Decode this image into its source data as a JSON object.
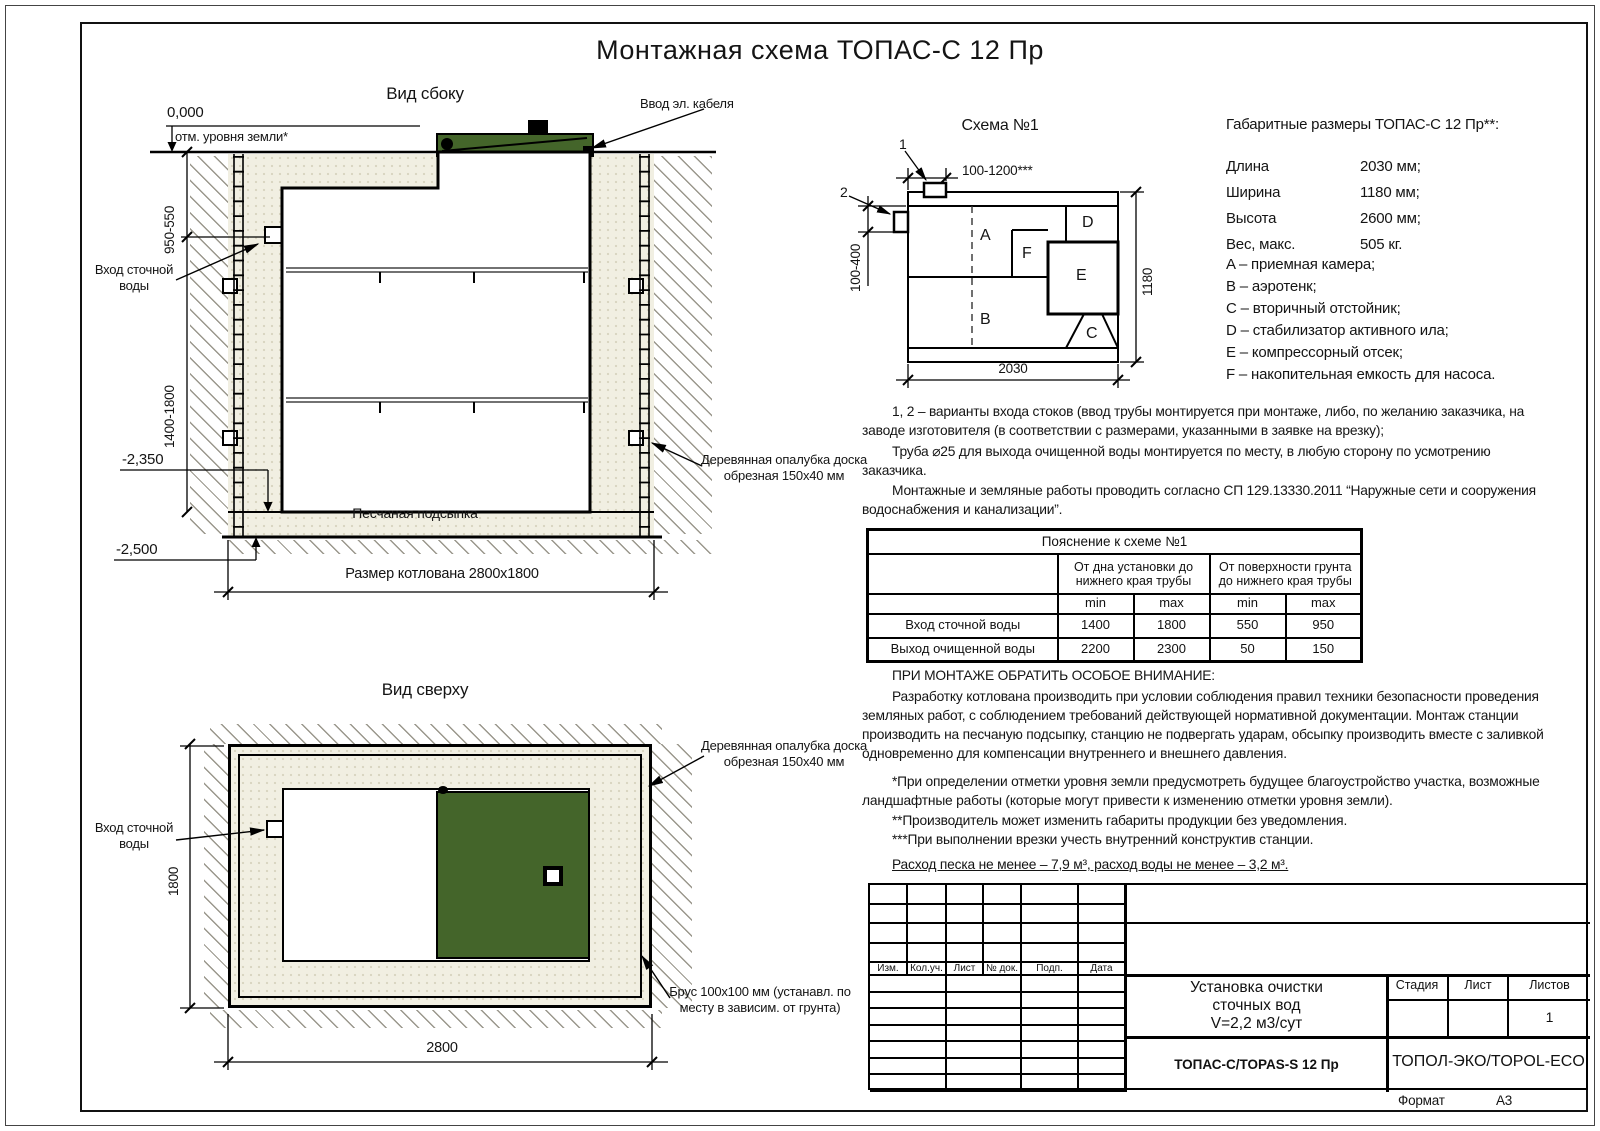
{
  "page": {
    "title": "Монтажная схема ТОПАС-С 12 Пр",
    "format_label": "Формат",
    "format_value": "А3"
  },
  "side_view": {
    "label": "Вид сбоку",
    "elev_zero": "0,000",
    "elev_zero_note": "отм. уровня земли*",
    "dim_upper": "950-550",
    "dim_lower": "1400-1800",
    "inlet_label": "Вход сточной воды",
    "elev_sand": "-2,350",
    "elev_bottom": "-2,500",
    "cable_label": "Ввод эл. кабеля",
    "formwork_label": "Деревянная опалубка доска обрезная 150x40 мм",
    "sand_label": "Песчаная подсыпка",
    "pit_dim": "Размер котлована 2800x1800"
  },
  "top_view": {
    "label": "Вид сверху",
    "inlet_label": "Вход сточной воды",
    "dim_width": "1800",
    "dim_length": "2800",
    "formwork_label": "Деревянная опалубка доска обрезная 150x40 мм",
    "beam_label": "Брус 100x100 мм (устанавл. по месту в зависим. от грунта)"
  },
  "schema": {
    "title": "Схема №1",
    "marker1": "1",
    "marker2": "2",
    "dim_top": "100-1200***",
    "dim_left": "100-400",
    "dim_right": "1180",
    "dim_bottom": "2030",
    "zone_a": "A",
    "zone_b": "B",
    "zone_c": "C",
    "zone_d": "D",
    "zone_e": "E",
    "zone_f": "F"
  },
  "specs": {
    "title": "Габаритные размеры ТОПАС-С 12 Пр**:",
    "rows": [
      {
        "label": "Длина",
        "value": "2030 мм;"
      },
      {
        "label": "Ширина",
        "value": "1180 мм;"
      },
      {
        "label": "Высота",
        "value": "2600 мм;"
      },
      {
        "label": "Вес, макс.",
        "value": "505 кг."
      }
    ],
    "legend": [
      "A – приемная камера;",
      "B – аэротенк;",
      "C – вторичный отстойник;",
      "D – стабилизатор активного ила;",
      "E – компрессорный отсек;",
      "F – накопительная емкость для насоса."
    ]
  },
  "notes": {
    "variants": "1, 2 – варианты входа  стоков (ввод трубы монтируется при монтаже, либо, по желанию заказчика, на заводе изготовителя (в соответствии с размерами, указанными в заявке на врезку);",
    "pipe": "Труба ⌀25 для выхода очищенной воды монтируется по месту, в любую сторону по усмотрению заказчика.",
    "mounting": "Монтажные и земляные работы проводить согласно СП 129.13330.2011 “Наружные сети и сооружения водоснабжения и канализации”.",
    "attention_title": "ПРИ МОНТАЖЕ ОБРАТИТЬ ОСОБОЕ ВНИМАНИЕ:",
    "attention_body": "Разработку котлована производить при условии соблюдения правил техники безопасности проведения земляных работ, с соблюдением требований действующей нормативной документации. Монтаж станции производить на песчаную подсыпку, станцию не подвергать ударам, обсыпку производить вместе с заливкой одновременно для компенсации внутреннего и внешнего давления.",
    "footnote1": "*При определении отметки уровня земли предусмотреть будущее благоустройство участка, возможные ландшафтные работы (которые могут привести к изменению отметки уровня земли).",
    "footnote2": "**Производитель может изменить габариты продукции без уведомления.",
    "footnote3": "***При выполнении врезки учесть внутренний конструктив станции.",
    "consumption": "Расход песка не менее – 7,9 м³, расход воды не менее – 3,2 м³."
  },
  "table": {
    "title": "Пояснение к схеме №1",
    "col_group1": "От дна установки до нижнего края трубы",
    "col_group2": "От поверхности грунта до нижнего края трубы",
    "min": "min",
    "max": "max",
    "rows": [
      {
        "label": "Вход сточной воды",
        "v1": "1400",
        "v2": "1800",
        "v3": "550",
        "v4": "950"
      },
      {
        "label": "Выход очищенной воды",
        "v1": "2200",
        "v2": "2300",
        "v3": "50",
        "v4": "150"
      }
    ]
  },
  "stamp": {
    "cols": [
      "Изм.",
      "Кол.уч.",
      "Лист",
      "№ док.",
      "Подп.",
      "Дата"
    ],
    "doc_title_line1": "Установка очистки",
    "doc_title_line2": "сточных вод",
    "doc_title_line3": "V=2,2 м3/сут",
    "stage": "Стадия",
    "sheet": "Лист",
    "sheets": "Листов",
    "sheets_value": "1",
    "model": "ТОПАС-С/TOPAS-S 12 Пр",
    "company": "ТОПОЛ-ЭКО/TOPOL-ECO"
  }
}
